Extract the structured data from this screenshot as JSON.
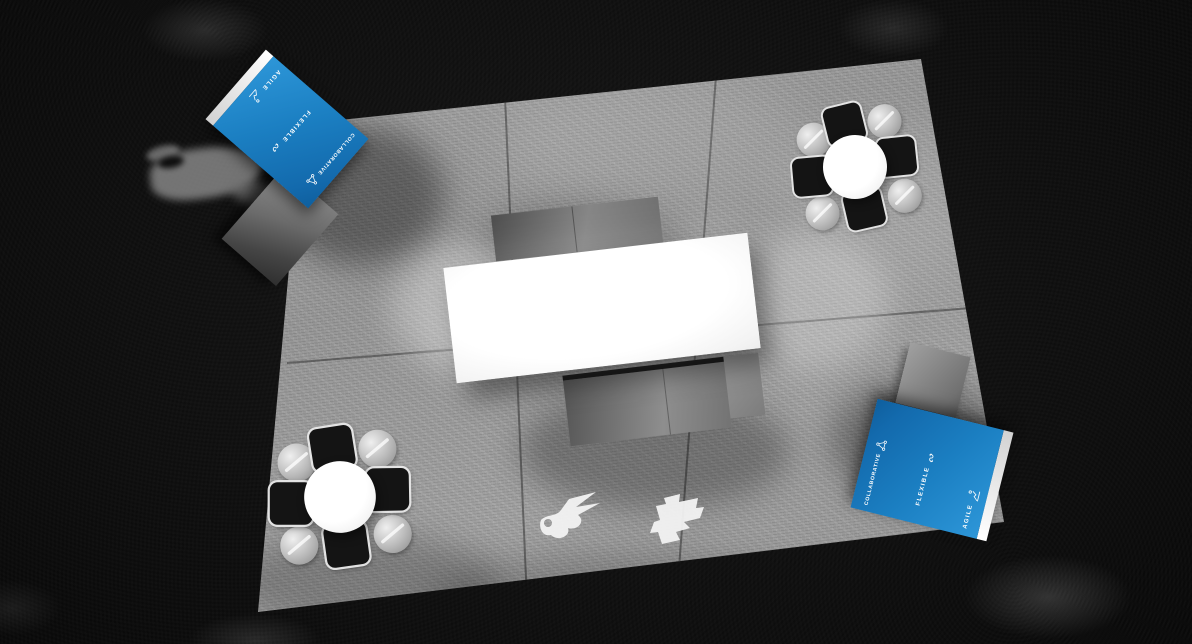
{
  "scene": {
    "type": "top-down 3d render of exhibition booth",
    "background_color": "#0d0d0d"
  },
  "colors": {
    "banner_blue": "#1b7fc2",
    "banner_edge_white": "#f4f4f4",
    "carpet_gray": "#999999",
    "table_white": "#ffffff",
    "chair_black": "#141414",
    "bench_gray": "#6e6e6e"
  },
  "banner": {
    "items": [
      {
        "label": "AGILE",
        "icon": "agile-icon"
      },
      {
        "label": "FLEXIBLE",
        "icon": "flexible-icon"
      },
      {
        "label": "COLLABORATIVE",
        "icon": "collaborative-icon"
      }
    ]
  }
}
